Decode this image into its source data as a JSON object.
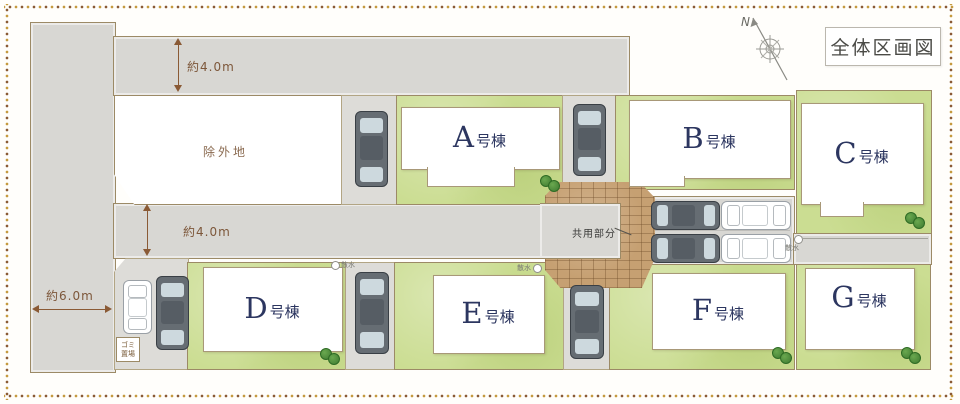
{
  "title": "全体区画図",
  "compass": {
    "north": "N"
  },
  "annotations": {
    "road_top_width": "約4.0m",
    "road_mid_width": "約4.0m",
    "road_left_width": "約6.0m",
    "excluded_land": "除外地",
    "common_area": "共用部分",
    "garbage_line1": "ゴミ",
    "garbage_line2": "置場",
    "tap_d": "散水",
    "tap_e": "散水",
    "tap_strip": "散水"
  },
  "buildings": [
    {
      "name": "A号棟",
      "letter": "A",
      "suffix": "号棟"
    },
    {
      "name": "B号棟",
      "letter": "B",
      "suffix": "号棟"
    },
    {
      "name": "C号棟",
      "letter": "C",
      "suffix": "号棟"
    },
    {
      "name": "D号棟",
      "letter": "D",
      "suffix": "号棟"
    },
    {
      "name": "E号棟",
      "letter": "E",
      "suffix": "号棟"
    },
    {
      "name": "F号棟",
      "letter": "F",
      "suffix": "号棟"
    },
    {
      "name": "G号棟",
      "letter": "G",
      "suffix": "号棟"
    }
  ],
  "colors": {
    "lawn": "#cbdd92",
    "road": "#d8d7d3",
    "stone": "#c6a072",
    "dimension_brown": "#8a5a35",
    "building_label_navy": "#2c3660",
    "dot_brown": "#8a5a35",
    "dot_gold": "#c59a3f"
  }
}
